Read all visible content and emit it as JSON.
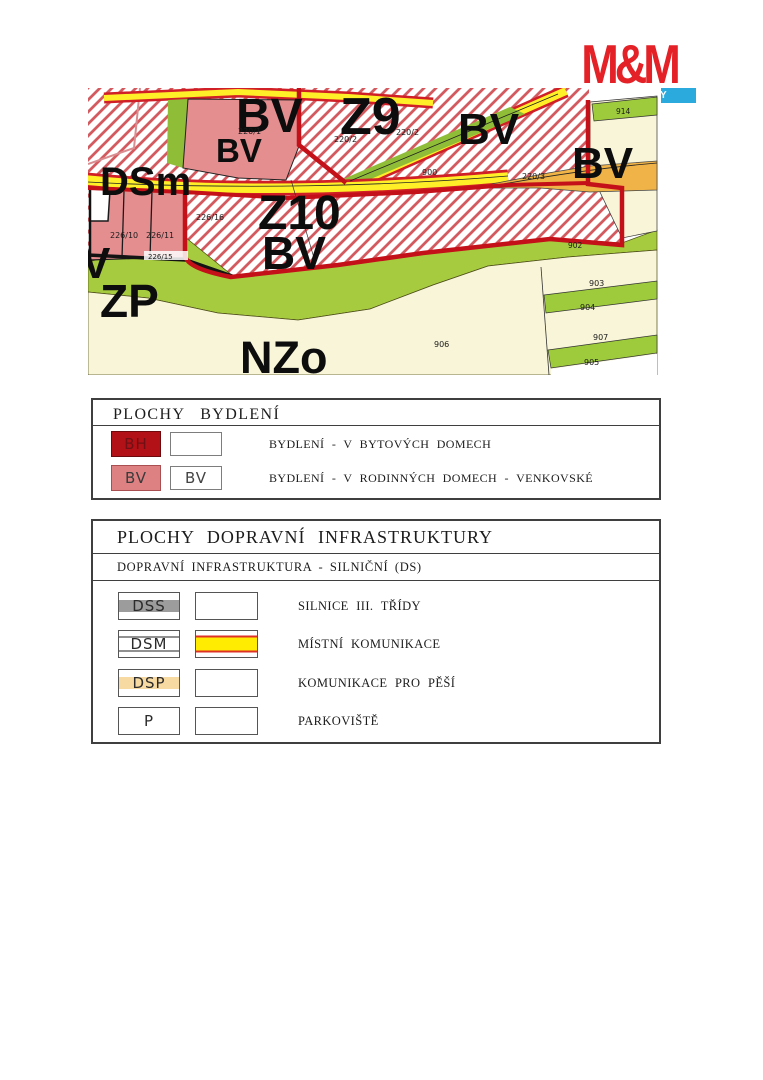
{
  "logo": {
    "brand": "M&M",
    "subtitle": "REALITY",
    "brand_color": "#e32127",
    "bar_color": "#2baade"
  },
  "map": {
    "zone_labels": [
      "BV",
      "BV",
      "Z9",
      "BV",
      "BV",
      "DSm",
      "Z10",
      "BV",
      "ZP",
      "NZo",
      "V"
    ],
    "parcel_labels": [
      "220/1",
      "220/2",
      "220/2",
      "900",
      "220/3",
      "226/10",
      "226/11",
      "226/16",
      "226/15",
      "914",
      "902",
      "903",
      "904",
      "907",
      "905",
      "906"
    ]
  },
  "legend_housing": {
    "title": "PLOCHY BYDLENÍ",
    "rows": [
      {
        "code": "BH",
        "code2": "",
        "description": "BYDLENÍ - V BYTOVÝCH DOMECH"
      },
      {
        "code": "BV",
        "code2": "BV",
        "description": "BYDLENÍ - V RODINNÝCH DOMECH - VENKOVSKÉ"
      }
    ]
  },
  "legend_transport": {
    "title": "PLOCHY DOPRAVNÍ INFRASTRUKTURY",
    "subtitle": "DOPRAVNÍ INFRASTRUKTURA - SILNIČNÍ (DS)",
    "rows": [
      {
        "code": "DSS",
        "description": "SILNICE III. TŘÍDY"
      },
      {
        "code": "DSM",
        "description": "MÍSTNÍ KOMUNIKACE"
      },
      {
        "code": "DSP",
        "description": "KOMUNIKACE PRO PĚŠÍ"
      },
      {
        "code": "P",
        "description": "PARKOVIŠTĚ"
      }
    ]
  },
  "palette": {
    "hatch_line": "#d35b60",
    "parcel_pink": "#e58e90",
    "zone_border_red": "#c41018",
    "road_yellow": "#ffef29",
    "road_edge_red": "#d01f26",
    "green": "#a6cb3f",
    "cream": "#f8f5d8",
    "orange": "#efb347",
    "legend_bh": "#b11117",
    "legend_bv": "#dd8183",
    "dss_gray": "#9c9c9c",
    "dsm_yellow": "#ffec00",
    "dsp_wheat": "#f7d9a2",
    "parking_green": "#e7f3a4",
    "logo_red": "#e32127",
    "logo_blue": "#2baade"
  }
}
